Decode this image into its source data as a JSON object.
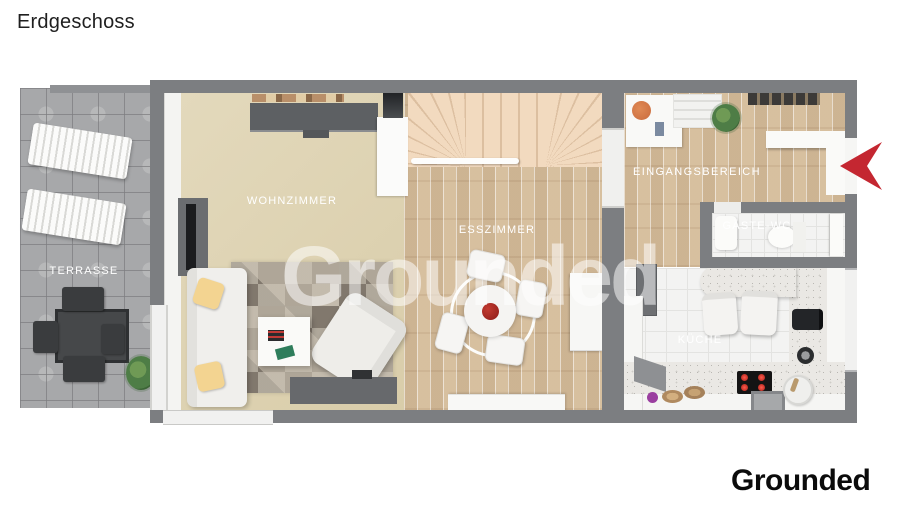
{
  "page": {
    "title": "Erdgeschoss",
    "watermark": "Grounded",
    "brand": "Grounded"
  },
  "floorplan": {
    "floor_name": "Erdgeschoss",
    "rooms": [
      {
        "id": "terrasse",
        "label": "TERRASSE"
      },
      {
        "id": "wohnzimmer",
        "label": "WOHNZIMMER"
      },
      {
        "id": "esszimmer",
        "label": "ESSZIMMER"
      },
      {
        "id": "eingangsbereich",
        "label": "EINGANGSBEREICH"
      },
      {
        "id": "gaeste-wc",
        "label": "GÄSTE-WC"
      },
      {
        "id": "kueche",
        "label": "KÜCHE"
      }
    ],
    "annotations": {
      "entrance_arrow": {
        "icon": "entrance-arrow-icon",
        "direction": "left",
        "color": "#c42731"
      }
    },
    "colors": {
      "wall": "#7c7e81",
      "living_floor": "#ddd2b2",
      "wood_floor": "#d7c1a2",
      "terrace_tiles": "#a7a8aa",
      "stairs": "#f2dabf",
      "tile_floor": "#f3f3f2",
      "accent_red": "#c42731",
      "watermark": "rgba(255,255,255,0.52)"
    }
  }
}
